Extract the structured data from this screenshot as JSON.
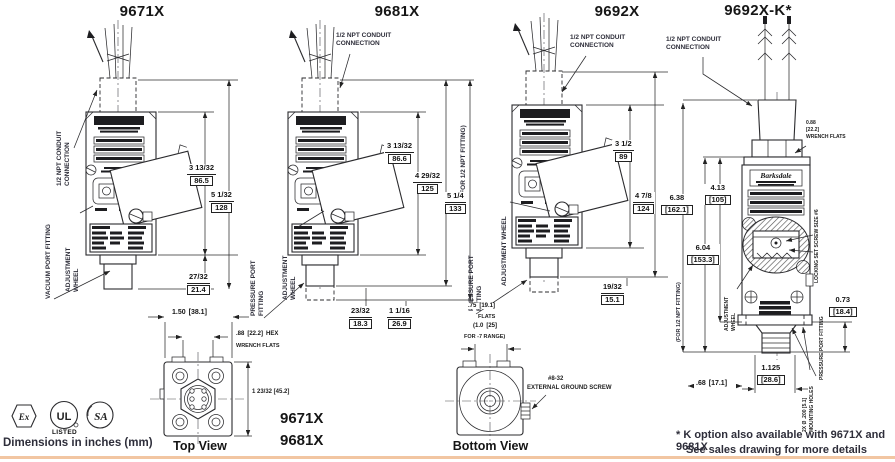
{
  "page": {
    "dims_note": "Dimensions in inches (mm)",
    "footnote_line1": "* K option also available with 9671X and 9681X",
    "footnote_line2": "See sales drawing for more details",
    "accent_color": "#f2c6a2"
  },
  "certs": {
    "ex": "Ex",
    "ul": "UL",
    "ul_listed": "LISTED",
    "csa": "SA"
  },
  "top_view": {
    "label": "Top View",
    "width_in": "1.50",
    "width_mm": "[38.1]",
    "hex_in": ".88",
    "hex_mm": "[22.2]",
    "hex_suffix": "HEX",
    "wrench_flats": "WRENCH FLATS",
    "height_dim": "1 23/32 [45.2]",
    "model_a": "9671X",
    "model_b": "9681X"
  },
  "bottom_view": {
    "label": "Bottom View",
    "flats_in": ".75",
    "flats_mm": "[19.1]",
    "flats_word": "FLATS",
    "range_in": "(1.0",
    "range_mm": "[25]",
    "range_word": "FOR -7 RANGE)",
    "ground_line1": "#8-32",
    "ground_line2": "EXTERNAL GROUND SCREW"
  },
  "p1": {
    "title": "9671X",
    "conduit_label": "1/2 NPT CONDUIT\nCONNECTION",
    "port_label": "VACUUM PORT FITTING",
    "wheel_label": "ADJUSTMENT\nWHEEL",
    "dim_body_in": "3 13/32",
    "dim_body_mm": "86.5",
    "dim_total_in": "5 1/32",
    "dim_total_mm": "128",
    "dim_port_in": "27/32",
    "dim_port_mm": "21.4"
  },
  "p2": {
    "title": "9681X",
    "conduit_label": "1/2 NPT CONDUIT\nCONNECTION",
    "port_label": "PRESSURE PORT\nFITTING",
    "wheel_label": "ADJUSTMENT\nWHEEL",
    "npt_note": "(FOR 1/2 NPT FITTING)",
    "dim_body_in": "3 13/32",
    "dim_body_mm": "86.6",
    "dim_mid_in": "4 29/32",
    "dim_mid_mm": "125",
    "dim_total_in": "5 1/4",
    "dim_total_mm": "133",
    "dim_thread_in": "23/32",
    "dim_thread_mm": "18.3",
    "dim_port_in": "1 1/16",
    "dim_port_mm": "26.9"
  },
  "p3": {
    "title": "9692X",
    "conduit_label": "1/2 NPT CONDUIT\nCONNECTION",
    "port_label": "PRESSURE PORT\nFITTING",
    "wheel_label": "ADJUSTMENT WHEEL",
    "dim_body_in": "3 1/2",
    "dim_body_mm": "89",
    "dim_total_in": "4 7/8",
    "dim_total_mm": "124",
    "dim_port_in": "19/32",
    "dim_port_mm": "15.1"
  },
  "p4": {
    "title": "9692X-K*",
    "conduit_label": "1/2 NPT CONDUIT\nCONNECTION",
    "brand": "Barksdale",
    "wrench_stack": "0.88\n[22.2]\nWRENCH FLATS",
    "npt_note": "(FOR 1/2 NPT FITTING)",
    "dim_a_in": "6.38",
    "dim_a_mm": "[162.1]",
    "dim_b_in": "4.13",
    "dim_b_mm": "[105]",
    "dim_c_in": "6.04",
    "dim_c_mm": "[153.3]",
    "dim_d_in": "0.73",
    "dim_d_mm": "[18.4]",
    "dim_e_in": ".68",
    "dim_e_mm": "[17.1]",
    "dim_f_in": "1.125",
    "dim_f_mm": "[28.6]",
    "locking_label": "LOCKING SET SCREW SIZE #6",
    "wheel_label": "ADJUSTMENT\nWHEEL",
    "port_label": "PRESSURE PORT FITTING",
    "mounting_label": "2X Ø .200 [5.1]\nMOUNTING HOLES"
  }
}
